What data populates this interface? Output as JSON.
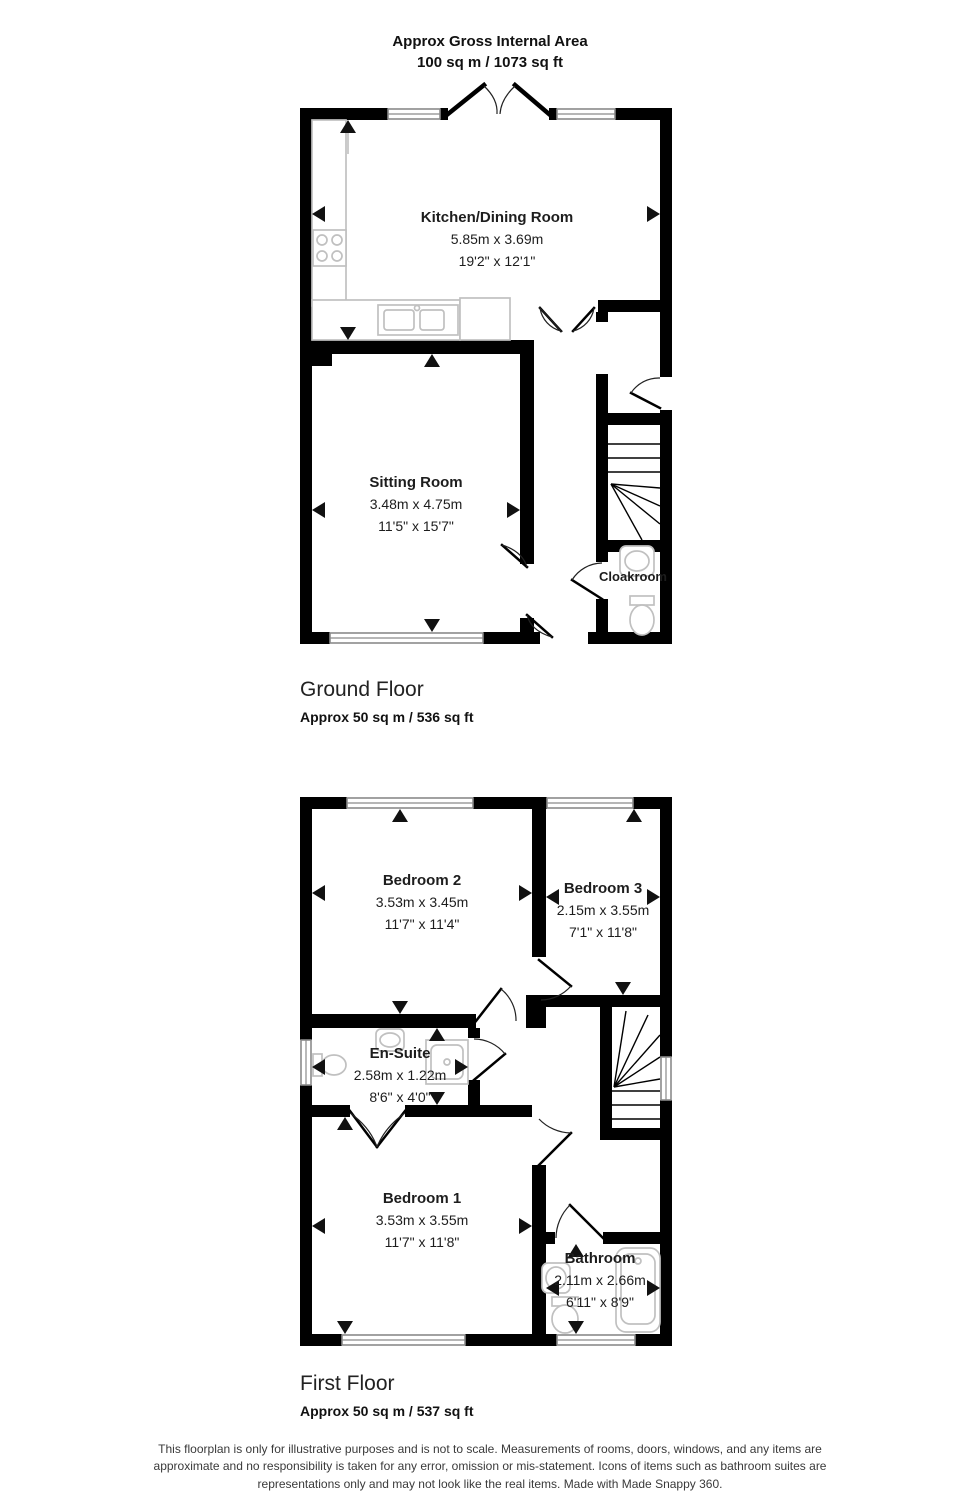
{
  "header": {
    "title": "Approx Gross Internal Area",
    "subtitle": "100 sq m / 1073 sq ft"
  },
  "floors": {
    "ground": {
      "title": "Ground Floor",
      "area": "Approx 50 sq m / 536 sq ft",
      "rooms": {
        "kitchen": {
          "name": "Kitchen/Dining Room",
          "metric": "5.85m x 3.69m",
          "imperial": "19'2\" x 12'1\""
        },
        "sitting": {
          "name": "Sitting Room",
          "metric": "3.48m x 4.75m",
          "imperial": "11'5\" x 15'7\""
        },
        "cloakroom": {
          "name": "Cloakroom"
        }
      }
    },
    "first": {
      "title": "First Floor",
      "area": "Approx 50 sq m / 537 sq ft",
      "rooms": {
        "bedroom2": {
          "name": "Bedroom 2",
          "metric": "3.53m x 3.45m",
          "imperial": "11'7\" x 11'4\""
        },
        "bedroom3": {
          "name": "Bedroom 3",
          "metric": "2.15m x 3.55m",
          "imperial": "7'1\" x 11'8\""
        },
        "ensuite": {
          "name": "En-Suite",
          "metric": "2.58m x 1.22m",
          "imperial": "8'6\" x 4'0\""
        },
        "bedroom1": {
          "name": "Bedroom 1",
          "metric": "3.53m x 3.55m",
          "imperial": "11'7\" x 11'8\""
        },
        "bathroom": {
          "name": "Bathroom",
          "metric": "2.11m x 2.66m",
          "imperial": "6'11\" x 8'9\""
        }
      }
    }
  },
  "footer": {
    "disclaimer": "This floorplan is only for illustrative purposes and is not to scale. Measurements of rooms, doors, windows, and any items are approximate and no responsibility is taken for any error, omission or mis-statement. Icons of items such as bathroom suites are representations only and may not look like the real items. Made with Made Snappy 360."
  },
  "colors": {
    "wall": "#000000",
    "fixture_outline": "#c0c0c0",
    "window_outline": "#8a8a8a",
    "text": "#1d1d1d"
  }
}
